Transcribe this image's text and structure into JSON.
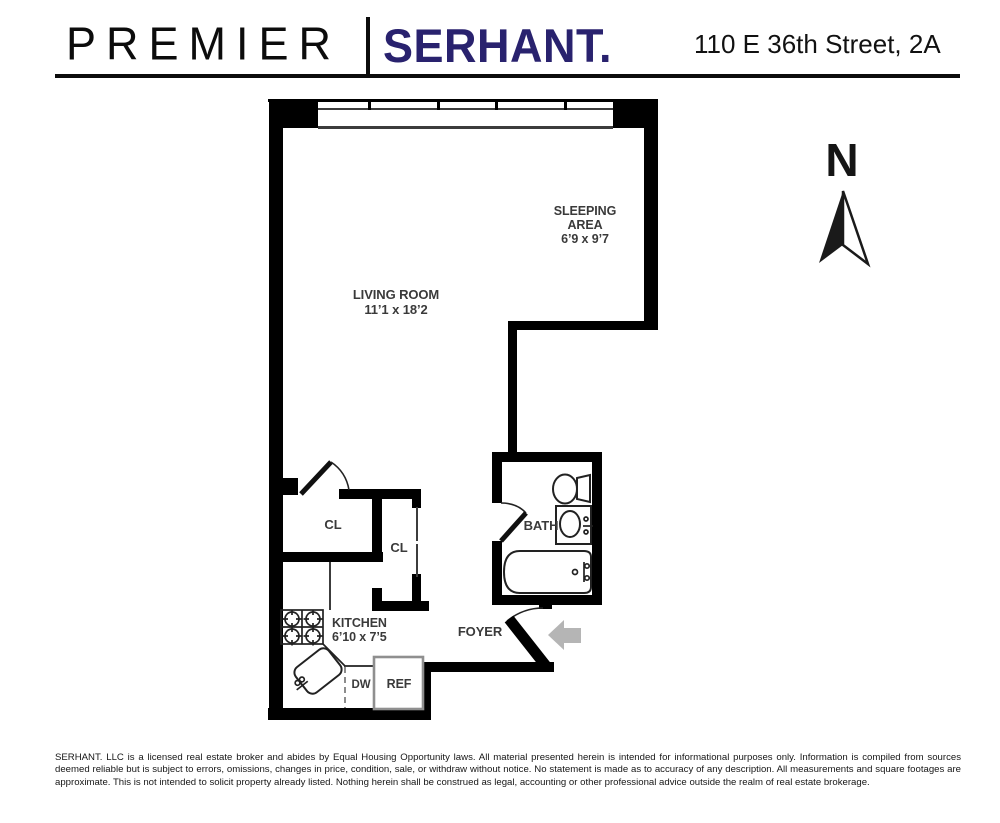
{
  "header": {
    "brand_left": "PREMIER",
    "brand_right": "SERHANT.",
    "address": "110 E 36th Street, 2A"
  },
  "floorplan": {
    "labels": {
      "sleeping_line1": "SLEEPING",
      "sleeping_line2": "AREA",
      "sleeping_dims": "6’9 x 9’7",
      "living_name": "LIVING ROOM",
      "living_dims": "11’1 x 18’2",
      "kitchen_name": "KITCHEN",
      "kitchen_dims": "6’10 x 7’5",
      "bath": "BATH",
      "foyer": "FOYER",
      "closet_upper": "CL",
      "closet_lower": "CL",
      "dishwasher": "DW",
      "refrigerator": "REF"
    },
    "compass_label": "N",
    "colors": {
      "wall": "#000000",
      "brand_navy": "#29226e",
      "entry_arrow": "#b5b5b5"
    }
  },
  "footer": {
    "disclaimer": "SERHANT. LLC is a licensed real estate broker and abides by Equal Housing Opportunity laws. All material presented herein is intended for informational purposes only. Information is compiled from sources deemed reliable but is subject to errors, omissions, changes in price, condition, sale, or withdraw without notice. No statement is made as to accuracy of any description. All measurements and square footages are approximate. This is not intended to solicit property already listed. Nothing herein shall be construed as legal, accounting or other professional advice outside the realm of real estate brokerage."
  }
}
